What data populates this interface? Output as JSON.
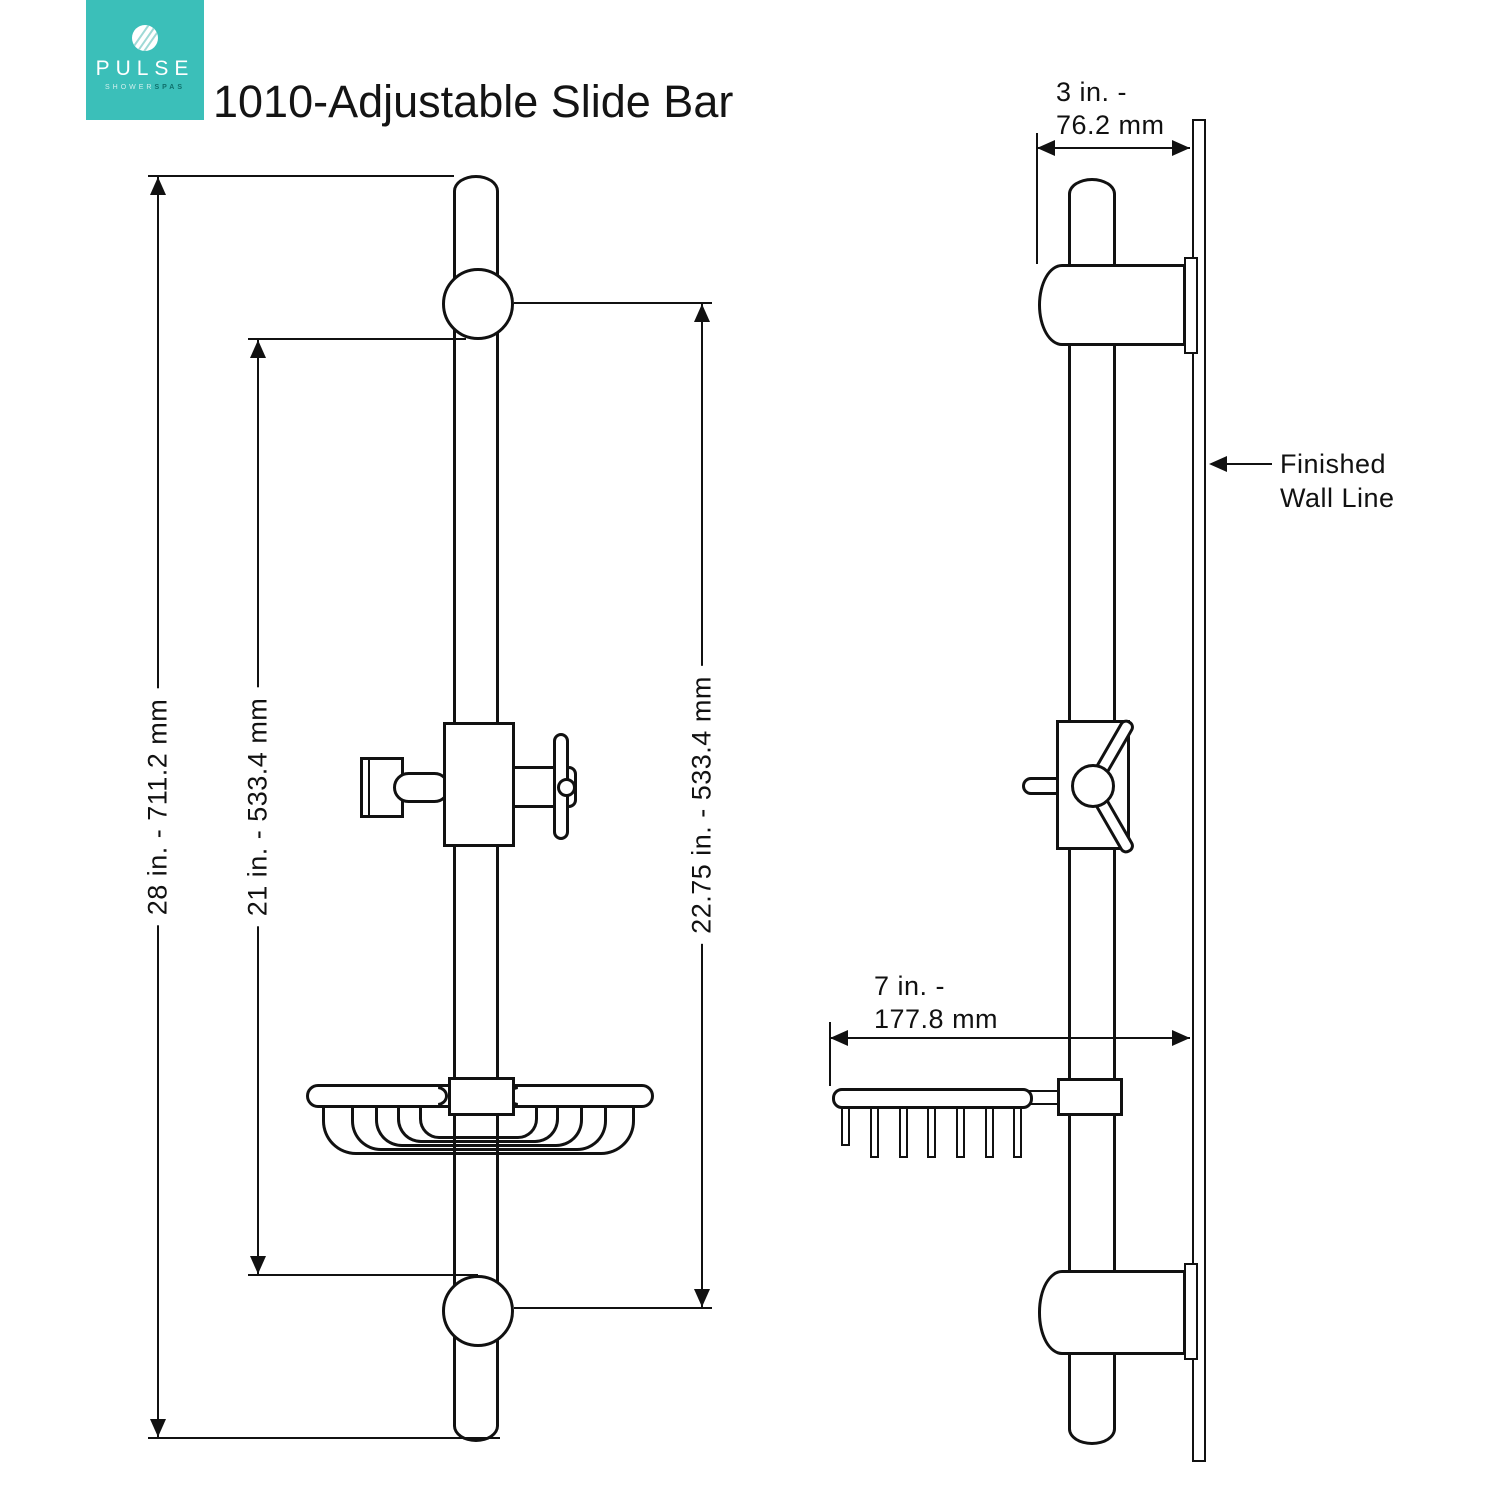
{
  "header": {
    "title": "1010-Adjustable Slide Bar",
    "logo": {
      "brand": "PULSE",
      "sub1": "SHOWER",
      "sub2": "SPAS",
      "bg_color": "#3BBFB9"
    }
  },
  "colors": {
    "line": "#111111",
    "accent_teal": "#3BBFB9",
    "background": "#FFFFFF"
  },
  "front_view": {
    "dim_overall": "28 in. - 711.2 mm",
    "dim_inner": "21 in. - 533.4 mm",
    "dim_travel": "22.75 in. - 533.4 mm"
  },
  "side_view": {
    "dim_depth_line1": "3 in. -",
    "dim_depth_line2": "76.2 mm",
    "dim_basket_line1": "7 in. -",
    "dim_basket_line2": "177.8 mm",
    "wall_label_line1": "Finished",
    "wall_label_line2": "Wall Line"
  }
}
